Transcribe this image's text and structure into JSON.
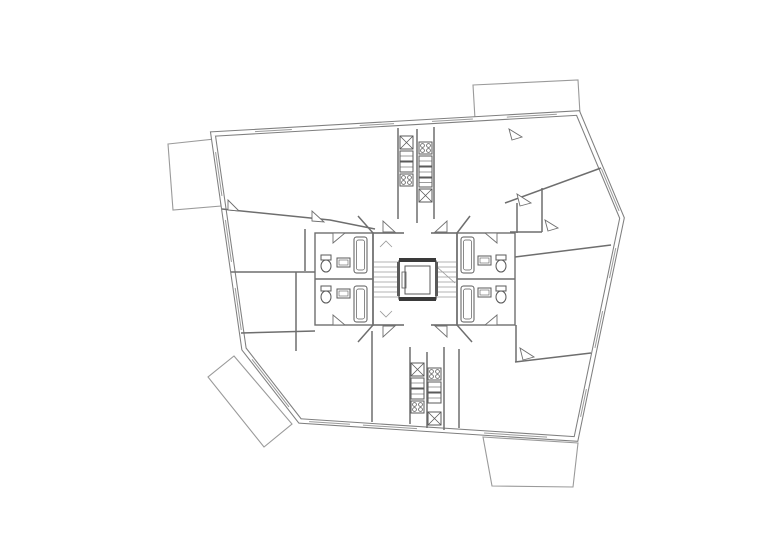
{
  "document": {
    "type": "architectural-floor-plan",
    "description": "typical floor plan with central stair and elevator core, four bathrooms, kitchen strips and four balconies",
    "background": "#ffffff"
  },
  "palette": {
    "exterior_wall": "#7f7f7f",
    "interior_wall": "#6e6e6e",
    "thin_line": "#9a9a9a",
    "fixture": "#5a5a5a",
    "dark": "#3a3a3a",
    "paper": "#ffffff"
  },
  "plan": {
    "canvas": {
      "width": 780,
      "height": 551
    },
    "exterior_outline": {
      "name": "exterior-wall",
      "points": [
        [
          213,
          134
        ],
        [
          578,
          113
        ],
        [
          622,
          218
        ],
        [
          576,
          439
        ],
        [
          300,
          421
        ],
        [
          244,
          349
        ]
      ],
      "outer_width": 5.5,
      "inner_width": 3.4
    },
    "balconies": [
      {
        "name": "balcony-top-left",
        "points": [
          [
            168,
            144
          ],
          [
            215,
            139
          ],
          [
            221,
            206
          ],
          [
            173,
            210
          ]
        ]
      },
      {
        "name": "balcony-top-right",
        "points": [
          [
            473,
            85
          ],
          [
            578,
            80
          ],
          [
            580,
            114
          ],
          [
            475,
            119
          ]
        ]
      },
      {
        "name": "balcony-bottom-left",
        "points": [
          [
            234,
            356
          ],
          [
            292,
            424
          ],
          [
            264,
            447
          ],
          [
            208,
            377
          ]
        ]
      },
      {
        "name": "balcony-bottom-right",
        "points": [
          [
            483,
            437
          ],
          [
            578,
            443
          ],
          [
            573,
            487
          ],
          [
            492,
            486
          ]
        ]
      }
    ],
    "windows": [
      {
        "edge": 0,
        "from": 0.115,
        "to": 0.216
      },
      {
        "edge": 0,
        "from": 0.402,
        "to": 0.496
      },
      {
        "edge": 0,
        "from": 0.6,
        "to": 0.712
      },
      {
        "edge": 0,
        "from": 0.805,
        "to": 0.942
      },
      {
        "edge": 1,
        "from": 0.533,
        "to": 0.933
      },
      {
        "edge": 2,
        "from": 0.136,
        "to": 0.272
      },
      {
        "edge": 2,
        "from": 0.421,
        "to": 0.588
      },
      {
        "edge": 2,
        "from": 0.774,
        "to": 0.9
      },
      {
        "edge": 3,
        "from": 0.105,
        "to": 0.333
      },
      {
        "edge": 3,
        "from": 0.576,
        "to": 0.772
      },
      {
        "edge": 3,
        "from": 0.819,
        "to": 0.967
      },
      {
        "edge": 4,
        "from": 0.196,
        "to": 0.857
      },
      {
        "edge": 5,
        "from": 0.088,
        "to": 0.284
      },
      {
        "edge": 5,
        "from": 0.405,
        "to": 0.6
      },
      {
        "edge": 5,
        "from": 0.712,
        "to": 0.916
      }
    ],
    "interior_walls": [
      [
        [
          222,
          209
        ],
        [
          330,
          220
        ],
        [
          375,
          229
        ]
      ],
      [
        [
          231,
          272
        ],
        [
          315,
          272
        ]
      ],
      [
        [
          305,
          229
        ],
        [
          305,
          271
        ]
      ],
      [
        [
          296,
          272
        ],
        [
          296,
          351
        ]
      ],
      [
        [
          241,
          333
        ],
        [
          315,
          331
        ]
      ],
      [
        [
          372,
          331
        ],
        [
          372,
          422
        ]
      ],
      [
        [
          398,
          128
        ],
        [
          398,
          219
        ]
      ],
      [
        [
          417,
          129
        ],
        [
          417,
          223
        ]
      ],
      [
        [
          434,
          127
        ],
        [
          434,
          219
        ]
      ],
      [
        [
          410,
          347
        ],
        [
          410,
          424
        ]
      ],
      [
        [
          427,
          352
        ],
        [
          427,
          428
        ]
      ],
      [
        [
          444,
          347
        ],
        [
          444,
          430
        ]
      ],
      [
        [
          459,
          349
        ],
        [
          459,
          428
        ]
      ],
      [
        [
          505,
          203
        ],
        [
          601,
          168
        ]
      ],
      [
        [
          517,
          203
        ],
        [
          517,
          233
        ]
      ],
      [
        [
          542,
          188
        ],
        [
          542,
          232
        ]
      ],
      [
        [
          510,
          232
        ],
        [
          542,
          232
        ]
      ],
      [
        [
          516,
          325
        ],
        [
          516,
          362
        ]
      ],
      [
        [
          515,
          257
        ],
        [
          611,
          245
        ]
      ],
      [
        [
          515,
          362
        ],
        [
          591,
          353
        ]
      ],
      [
        [
          373,
          233
        ],
        [
          358,
          216
        ]
      ],
      [
        [
          457,
          233
        ],
        [
          470,
          216
        ]
      ],
      [
        [
          373,
          325
        ],
        [
          358,
          342
        ]
      ],
      [
        [
          457,
          325
        ],
        [
          472,
          342
        ]
      ]
    ],
    "core": {
      "name": "stair-elevator-core",
      "rect": [
        373,
        233,
        84,
        92
      ],
      "openings": [
        [
          404,
          233,
          431,
          233
        ],
        [
          404,
          325,
          431,
          325
        ]
      ],
      "treads": {
        "ys": [
          262,
          267,
          272,
          277,
          282,
          287,
          292,
          297
        ],
        "left": [
          374,
          399
        ],
        "right": [
          436,
          456
        ]
      },
      "cut_line": [
        437,
        267,
        455,
        283
      ],
      "chevrons": [
        [
          [
            380,
            247
          ],
          [
            386,
            241
          ],
          [
            392,
            247
          ]
        ],
        [
          [
            380,
            311
          ],
          [
            386,
            317
          ],
          [
            392,
            311
          ]
        ]
      ],
      "elevator": {
        "name": "elevator",
        "outer": [
          399,
          261,
          37,
          38
        ],
        "bars": [
          [
            399,
            258,
            37,
            4
          ],
          [
            399,
            297,
            37,
            4
          ]
        ],
        "sides": [
          [
            397,
            262,
            3,
            34
          ],
          [
            435,
            262,
            3,
            34
          ]
        ],
        "inner": [
          405,
          266,
          25,
          28
        ],
        "panel": [
          402,
          272,
          4,
          16
        ]
      }
    },
    "bathrooms": {
      "blocks": [
        {
          "name": "bathroom-block-left",
          "rect": [
            315,
            233,
            58,
            92
          ],
          "divider": [
            315,
            279,
            373,
            279
          ]
        },
        {
          "name": "bathroom-block-right",
          "rect": [
            457,
            233,
            58,
            92
          ],
          "divider": [
            457,
            279,
            515,
            279
          ]
        }
      ],
      "tubs": [
        [
          354,
          237,
          13,
          36
        ],
        [
          354,
          286,
          13,
          36
        ],
        [
          461,
          237,
          13,
          36
        ],
        [
          461,
          286,
          13,
          36
        ]
      ],
      "sinks": [
        [
          337,
          258,
          13,
          9
        ],
        [
          337,
          289,
          13,
          9
        ],
        [
          478,
          256,
          13,
          9
        ],
        [
          478,
          288,
          13,
          9
        ]
      ],
      "toilets": [
        {
          "tank": [
            321,
            255,
            10,
            5
          ],
          "bowl": [
            326,
            266,
            5,
            6
          ]
        },
        {
          "tank": [
            321,
            286,
            10,
            5
          ],
          "bowl": [
            326,
            297,
            5,
            6
          ]
        },
        {
          "tank": [
            496,
            255,
            10,
            5
          ],
          "bowl": [
            501,
            266,
            5,
            6
          ]
        },
        {
          "tank": [
            496,
            286,
            10,
            5
          ],
          "bowl": [
            501,
            297,
            5,
            6
          ]
        }
      ]
    },
    "kitchens": [
      {
        "name": "kitchen-strip-top-left",
        "x": 400,
        "w": 13,
        "units": [
          {
            "t": "sink",
            "y": 136,
            "h": 13
          },
          {
            "t": "cab",
            "y": 151,
            "h": 10
          },
          {
            "t": "cab",
            "y": 162,
            "h": 10
          },
          {
            "t": "stove",
            "y": 174,
            "h": 12
          }
        ]
      },
      {
        "name": "kitchen-strip-top-right",
        "x": 419,
        "w": 13,
        "units": [
          {
            "t": "stove",
            "y": 142,
            "h": 12
          },
          {
            "t": "cab",
            "y": 156,
            "h": 10
          },
          {
            "t": "cab",
            "y": 167,
            "h": 10
          },
          {
            "t": "cab",
            "y": 178,
            "h": 9
          },
          {
            "t": "sink",
            "y": 189,
            "h": 13
          }
        ]
      },
      {
        "name": "kitchen-strip-bottom-left",
        "x": 411,
        "w": 13,
        "units": [
          {
            "t": "sink",
            "y": 363,
            "h": 13
          },
          {
            "t": "cab",
            "y": 378,
            "h": 10
          },
          {
            "t": "cab",
            "y": 389,
            "h": 10
          },
          {
            "t": "stove",
            "y": 401,
            "h": 12
          }
        ]
      },
      {
        "name": "kitchen-strip-bottom-right",
        "x": 428,
        "w": 13,
        "units": [
          {
            "t": "stove",
            "y": 368,
            "h": 12
          },
          {
            "t": "cab",
            "y": 382,
            "h": 10
          },
          {
            "t": "cab",
            "y": 393,
            "h": 10
          },
          {
            "t": "sink",
            "y": 412,
            "h": 13
          }
        ]
      }
    ],
    "door_leaves": [
      [
        [
          383,
          232
        ],
        [
          395,
          232
        ],
        [
          383,
          221
        ]
      ],
      [
        [
          447,
          232
        ],
        [
          435,
          232
        ],
        [
          447,
          221
        ]
      ],
      [
        [
          383,
          326
        ],
        [
          395,
          326
        ],
        [
          383,
          337
        ]
      ],
      [
        [
          447,
          326
        ],
        [
          435,
          326
        ],
        [
          447,
          337
        ]
      ],
      [
        [
          333,
          233
        ],
        [
          345,
          233
        ],
        [
          333,
          243
        ]
      ],
      [
        [
          333,
          325
        ],
        [
          345,
          325
        ],
        [
          333,
          315
        ]
      ],
      [
        [
          497,
          233
        ],
        [
          485,
          233
        ],
        [
          497,
          243
        ]
      ],
      [
        [
          497,
          325
        ],
        [
          485,
          325
        ],
        [
          497,
          315
        ]
      ],
      [
        [
          312,
          221
        ],
        [
          324,
          222
        ],
        [
          312,
          211
        ]
      ],
      [
        [
          520,
          206
        ],
        [
          531,
          203
        ],
        [
          517,
          194
        ]
      ],
      [
        [
          548,
          231
        ],
        [
          558,
          228
        ],
        [
          545,
          220
        ]
      ],
      [
        [
          523,
          360
        ],
        [
          534,
          357
        ],
        [
          520,
          348
        ]
      ],
      [
        [
          228,
          210
        ],
        [
          239,
          211
        ],
        [
          228,
          200
        ]
      ],
      [
        [
          512,
          140
        ],
        [
          522,
          137
        ],
        [
          509,
          129
        ]
      ]
    ]
  }
}
